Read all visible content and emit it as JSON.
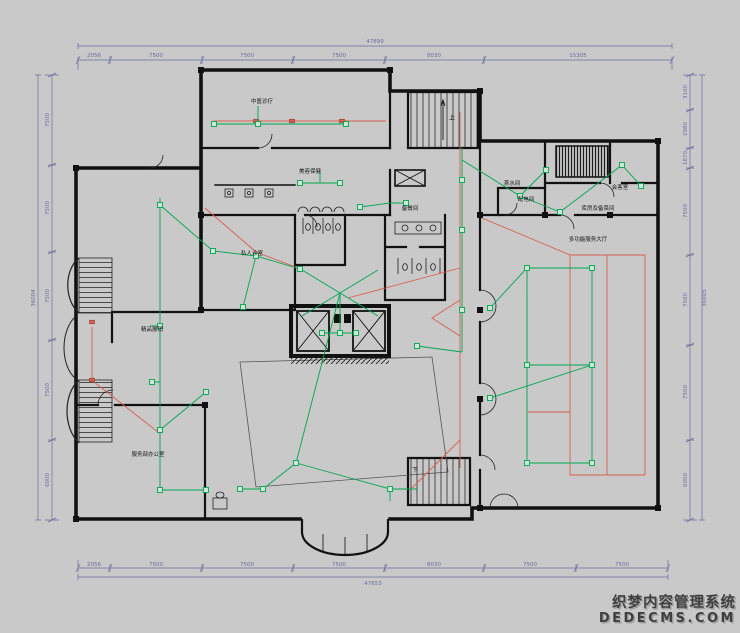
{
  "colors": {
    "background": "#c9c9c9",
    "wall": "#111111",
    "wiring_green": "#00A651",
    "wiring_red": "#D95F4C",
    "dimension": "#6b6b9e",
    "watermark": "#3f3f3f"
  },
  "watermark": {
    "line1": "织梦内容管理系统",
    "line2": "DEDECMS.COM"
  },
  "dimensions": {
    "top": {
      "total": "47899",
      "seg": [
        "2056",
        "7500",
        "7500",
        "7500",
        "8030",
        "15305"
      ]
    },
    "bottom": {
      "total": "47653",
      "seg": [
        "2056",
        "7500",
        "7500",
        "7500",
        "8030",
        "7500",
        "7500"
      ]
    },
    "left": {
      "total": "36004",
      "seg": [
        "7500",
        "7500",
        "7500",
        "7500",
        "6000"
      ]
    },
    "right": {
      "total": "36005",
      "seg": [
        "3100",
        "2980",
        "1670",
        "7500",
        "7500",
        "7500",
        "6000"
      ]
    }
  },
  "rooms": [
    {
      "label": "中医诊疗"
    },
    {
      "label": "美容保健"
    },
    {
      "label": "备餐间"
    },
    {
      "label": "私人诊室"
    },
    {
      "label": "茶水间"
    },
    {
      "label": "配电间"
    },
    {
      "label": "会客室"
    },
    {
      "label": "库房及备菜间"
    },
    {
      "label": "多功能服务大厅"
    },
    {
      "label": "精品展销"
    },
    {
      "label": "服务部办公室"
    }
  ],
  "stairs": {
    "up": "上",
    "down": "下"
  }
}
